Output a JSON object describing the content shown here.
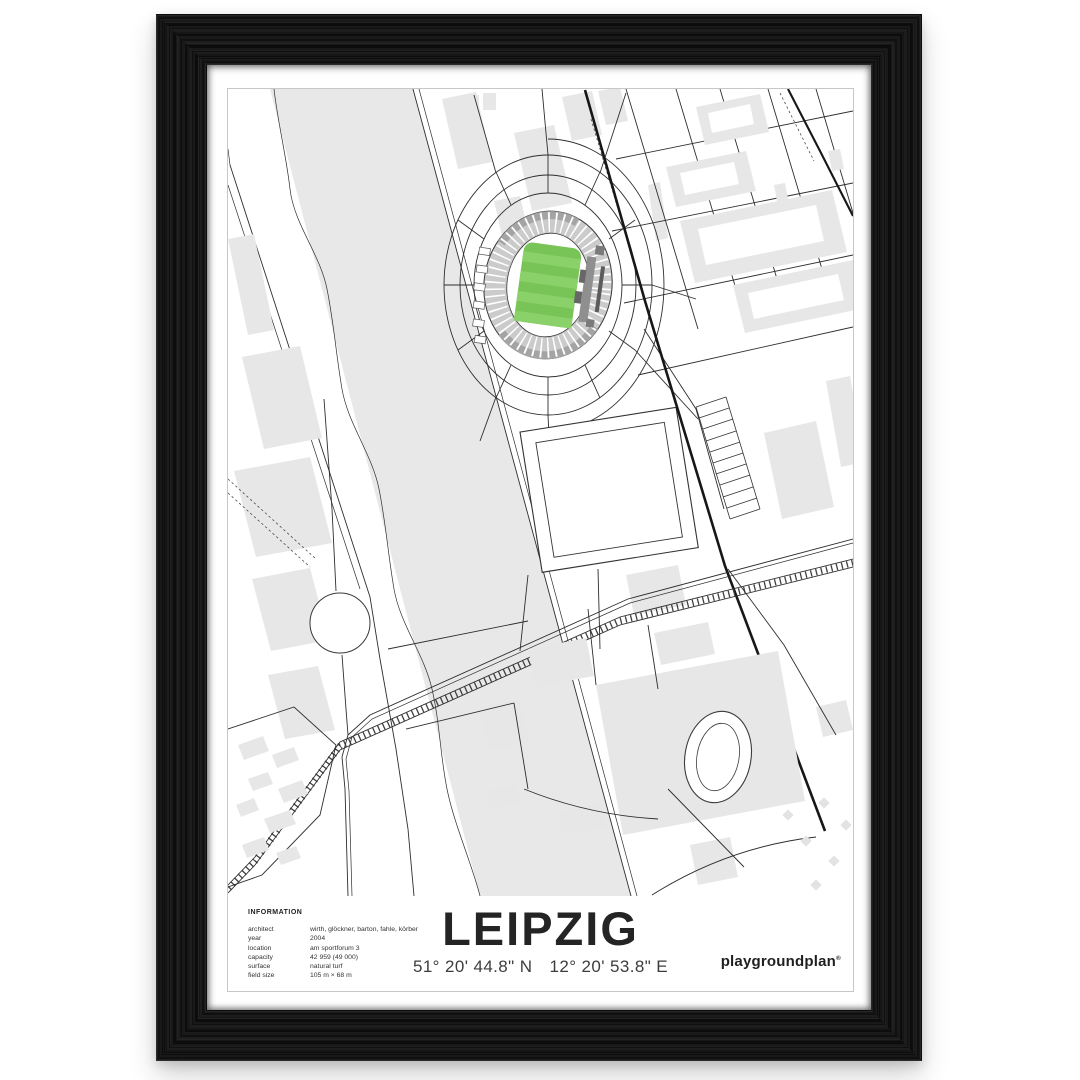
{
  "poster": {
    "title": "LEIPZIG",
    "coordinates": {
      "lat": "51° 20' 44.8\" N",
      "lon": "12° 20' 53.8\" E"
    },
    "brand": {
      "name": "playgroundplan",
      "mark": "®"
    },
    "info": {
      "heading": "INFORMATION",
      "rows": [
        {
          "label": "architect",
          "value": "wirth, glöckner, barton, fahle, körber"
        },
        {
          "label": "year",
          "value": "2004"
        },
        {
          "label": "location",
          "value": "am sportforum 3"
        },
        {
          "label": "capacity",
          "value": "42 959 (49 000)"
        },
        {
          "label": "surface",
          "value": "natural turf"
        },
        {
          "label": "field size",
          "value": "105 m × 68 m"
        }
      ]
    },
    "map_colors": {
      "water_band": "#e8e8e8",
      "building_gray": "#e7e7e7",
      "line": "#2e2e2e",
      "stand_gray": "#cbcbcb",
      "stand_dark": "#8f8f8f",
      "pitch_green": "#79c457",
      "pitch_stripe": "#8bd16a",
      "frame_black": "#151515"
    }
  }
}
